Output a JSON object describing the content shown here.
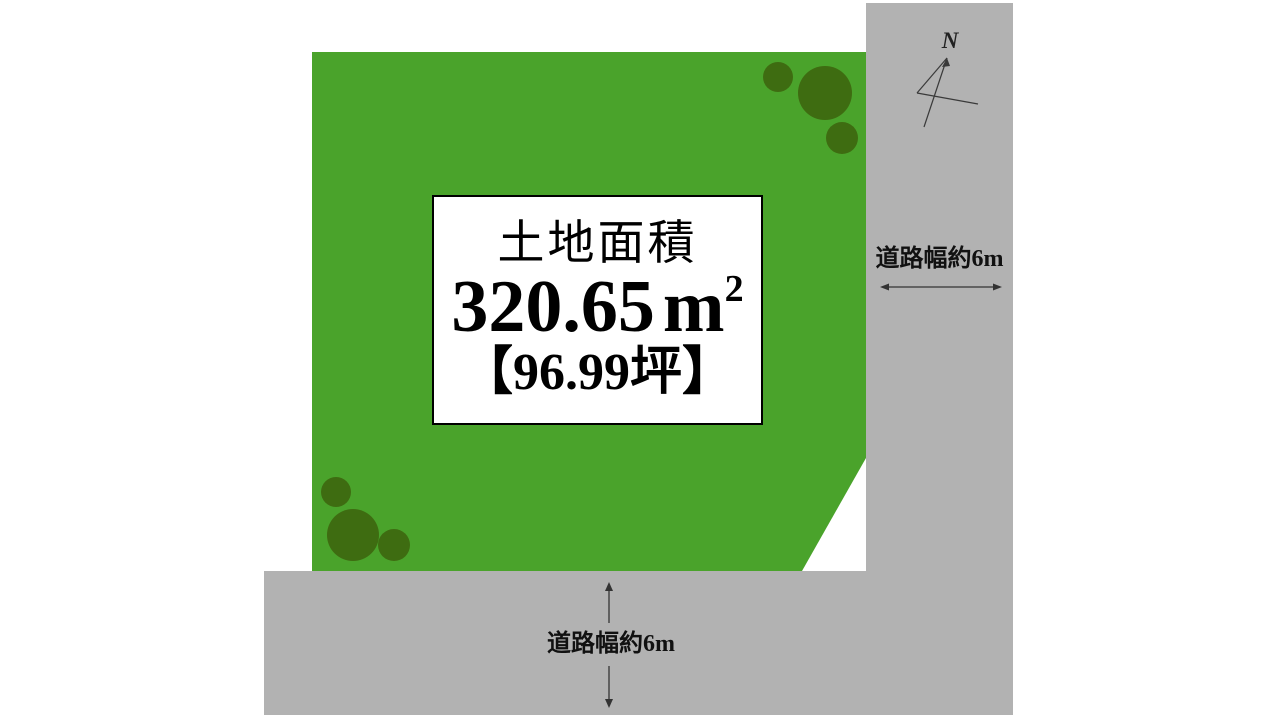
{
  "plot": {
    "area_title": "土地面積",
    "area_value": "320.65",
    "area_unit_base": "m",
    "area_unit_sup": "2",
    "area_tsubo": "【96.99坪】"
  },
  "roads": {
    "right_label": "道路幅約6m",
    "bottom_label": "道路幅約6m"
  },
  "compass": {
    "north_label": "N"
  },
  "colors": {
    "plot_green": "#4aa32b",
    "tree_green": "#3e6c11",
    "road_gray": "#b2b2b2",
    "background": "#ffffff",
    "ink": "#111111"
  }
}
